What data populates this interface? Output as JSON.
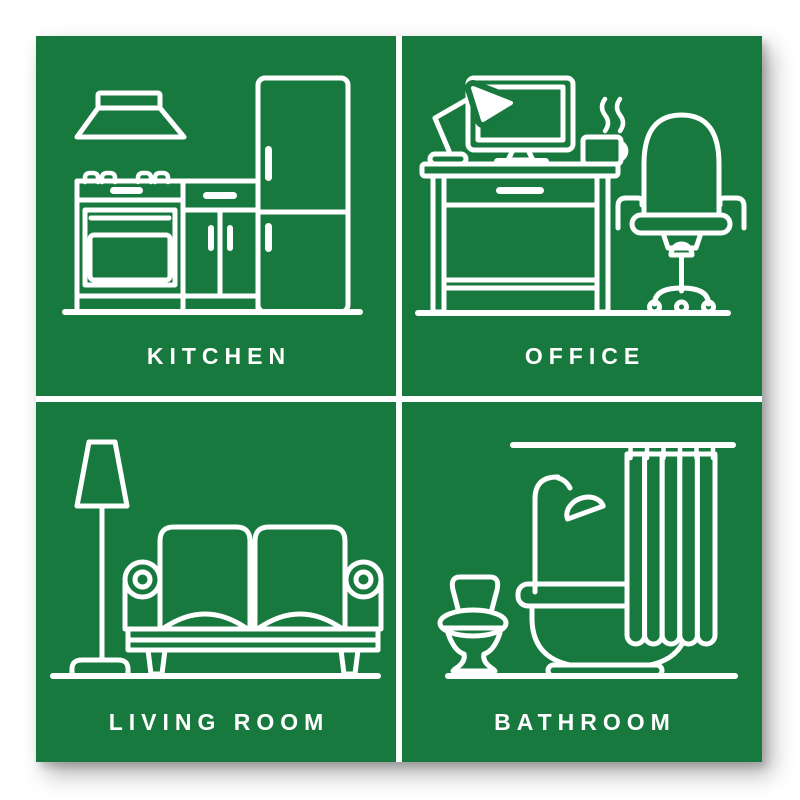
{
  "poster": {
    "background_color": "#ffffff",
    "panel_color": "#17793d",
    "line_color": "#ffffff",
    "panels": [
      {
        "label": "KITCHEN",
        "icon": "kitchen-icon",
        "objects": [
          "extractor-hood",
          "stove-oven",
          "cabinet",
          "fridge"
        ]
      },
      {
        "label": "OFFICE",
        "icon": "office-icon",
        "objects": [
          "desk-lamp",
          "monitor",
          "steaming-mug",
          "desk-with-drawer",
          "office-chair"
        ]
      },
      {
        "label": "LIVING ROOM",
        "icon": "living-room-icon",
        "objects": [
          "floor-lamp",
          "sofa"
        ]
      },
      {
        "label": "BATHROOM",
        "icon": "bathroom-icon",
        "objects": [
          "toilet",
          "shower",
          "bathtub",
          "shower-curtain",
          "curtain-rail"
        ]
      }
    ]
  }
}
